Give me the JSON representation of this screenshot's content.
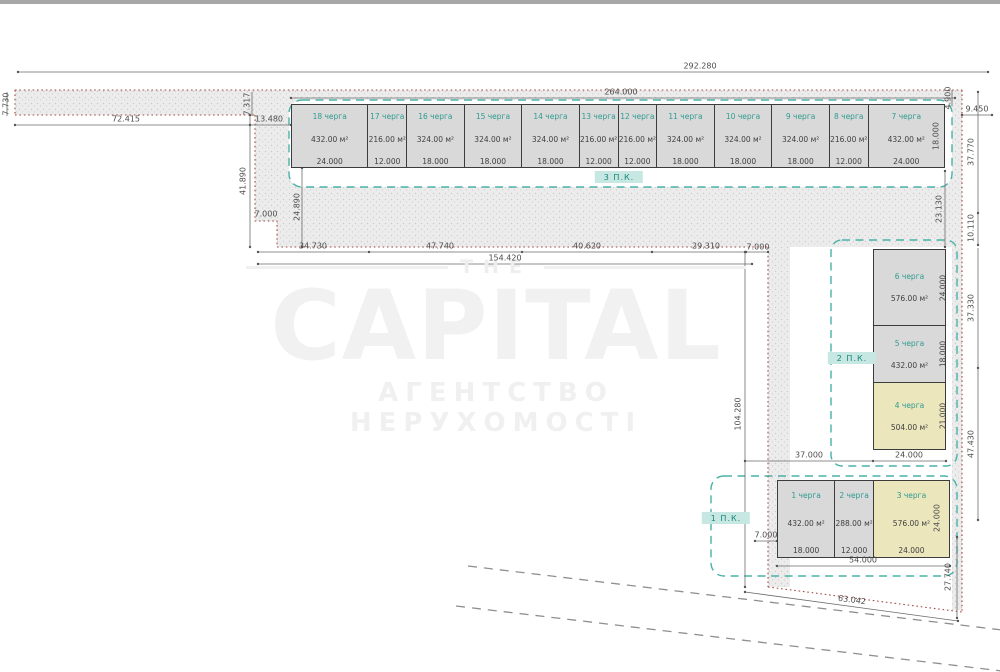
{
  "watermark": {
    "top": "THE",
    "main": "CAPITAL",
    "sub": "АГЕНТСТВО НЕРУХОМОСТІ"
  },
  "blocks": {
    "top": {
      "label": "3 П.К.",
      "units": [
        {
          "name": "18 черга",
          "area": "432.00 м²",
          "size": "24.000",
          "color": "gray"
        },
        {
          "name": "17 черга",
          "area": "216.00 м²",
          "size": "12.000",
          "color": "gray"
        },
        {
          "name": "16 черга",
          "area": "324.00 м²",
          "size": "18.000",
          "color": "gray"
        },
        {
          "name": "15 черга",
          "area": "324.00 м²",
          "size": "18.000",
          "color": "gray"
        },
        {
          "name": "14 черга",
          "area": "324.00 м²",
          "size": "18.000",
          "color": "gray"
        },
        {
          "name": "13 черга",
          "area": "216.00 м²",
          "size": "12.000",
          "color": "gray"
        },
        {
          "name": "12 черга",
          "area": "216.00 м²",
          "size": "12.000",
          "color": "gray"
        },
        {
          "name": "11 черга",
          "area": "324.00 м²",
          "size": "18.000",
          "color": "gray"
        },
        {
          "name": "10 черга",
          "area": "324.00 м²",
          "size": "18.000",
          "color": "gray"
        },
        {
          "name": "9 черга",
          "area": "324.00 м²",
          "size": "18.000",
          "color": "gray"
        },
        {
          "name": "8 черга",
          "area": "216.00 м²",
          "size": "12.000",
          "color": "gray"
        },
        {
          "name": "7 черга",
          "area": "432.00 м²",
          "size": "24.000",
          "color": "gray"
        }
      ]
    },
    "right": {
      "label": "2 П.К.",
      "units": [
        {
          "name": "6 черга",
          "area": "576.00 м²",
          "size": "24.000",
          "color": "gray"
        },
        {
          "name": "5 черга",
          "area": "432.00 м²",
          "size": "18.000",
          "color": "gray"
        },
        {
          "name": "4 черга",
          "area": "504.00 м²",
          "size": "21.000",
          "color": "yellow"
        }
      ]
    },
    "bottom": {
      "label": "1 П.К.",
      "units": [
        {
          "name": "1 черга",
          "area": "432.00 м²",
          "size": "18.000",
          "color": "gray"
        },
        {
          "name": "2 черга",
          "area": "288.00 м²",
          "size": "12.000",
          "color": "gray"
        },
        {
          "name": "3 черга",
          "area": "576.00 м²",
          "size": "24.000",
          "color": "yellow"
        }
      ]
    }
  },
  "dims": {
    "d292280": "292.280",
    "d264000": "264.000",
    "d72415": "72.415",
    "d7730": "7.730",
    "d7317": "7.317",
    "d13480": "13.480",
    "d41890": "41.890",
    "d24890": "24.890",
    "d7000": "7.000",
    "d4900": "4.900",
    "d9450": "9.450",
    "d18000": "18.000",
    "d23130": "23.130",
    "d37770": "37.770",
    "d10110": "10.110",
    "d34730": "34.730",
    "d47740": "47.740",
    "d40620": "40.620",
    "d29310": "29.310",
    "d154420": "154.420",
    "d104280": "104.280",
    "d37330": "37.330",
    "d47430": "47.430",
    "d37000": "37.000",
    "d24000": "24.000",
    "d54000": "54.000",
    "d63042": "63.042",
    "d27740": "27.740"
  },
  "colors": {
    "teal_dashed": "#49b2a8",
    "red_dotted": "#a04a3e",
    "building_gray": "#d9d9d9",
    "building_yellow": "#ece6bd",
    "badge_bg": "#c7e7e2",
    "badge_text": "#16867b",
    "unit_name_text": "#2f9b91"
  }
}
